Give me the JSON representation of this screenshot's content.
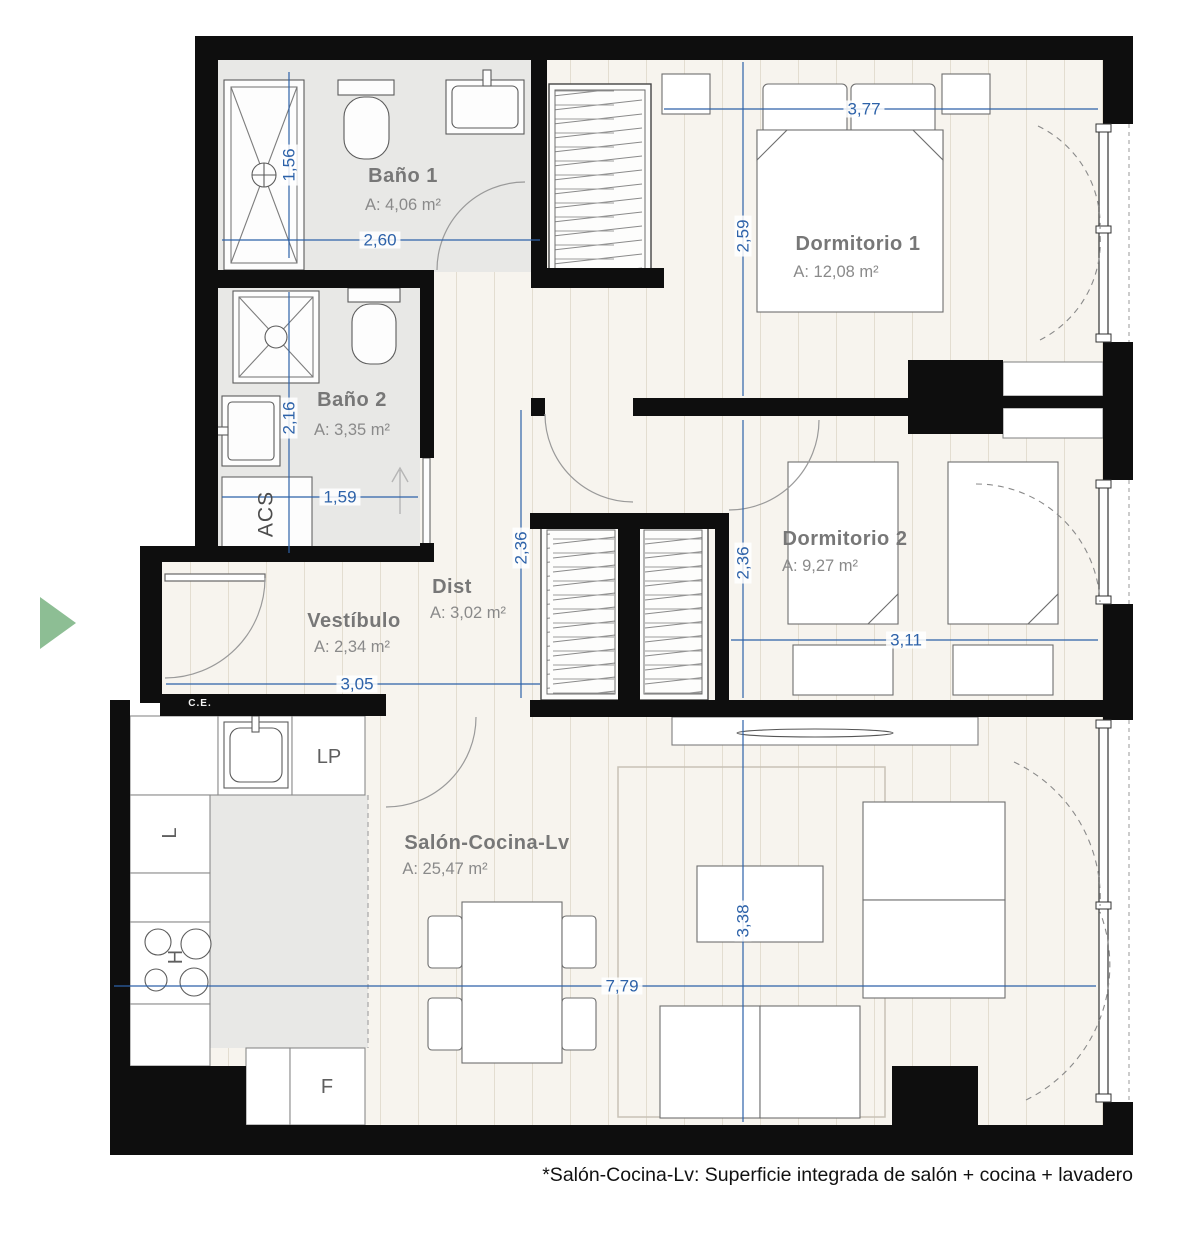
{
  "plan": {
    "footnote": "*Salón-Cocina-Lv: Superficie integrada de salón + cocina + lavadero",
    "rooms": {
      "bano1": {
        "name": "Baño 1",
        "area": "A: 4,06 m²",
        "width": "2,60",
        "height": "1,56"
      },
      "bano2": {
        "name": "Baño 2",
        "area": "A: 3,35 m²",
        "width": "1,59",
        "height": "2,16"
      },
      "dormitorio1": {
        "name": "Dormitorio 1",
        "area": "A: 12,08 m²",
        "width": "3,77",
        "height": "2,59"
      },
      "dormitorio2": {
        "name": "Dormitorio 2",
        "area": "A: 9,27 m²",
        "width": "3,11",
        "height": "2,36"
      },
      "dist": {
        "name": "Dist",
        "area": "A: 3,02 m²",
        "height": "2,36"
      },
      "vestibulo": {
        "name": "Vestíbulo",
        "area": "A: 2,34 m²",
        "width": "3,05"
      },
      "salon": {
        "name": "Salón-Cocina-Lv",
        "area": "A: 25,47 m²",
        "width": "7,79",
        "height": "3,38"
      }
    },
    "fixtures": {
      "acs": "ACS",
      "ce": "C.E.",
      "lp": "LP",
      "l": "L",
      "h": "H",
      "f": "F"
    },
    "colors": {
      "dimension_blue": "#2d62a9",
      "room_label_gray": "#777777",
      "wall_black": "#0e0e0e",
      "floor_wood": "#f7f4ee",
      "floor_tile": "#e8e8e6",
      "entry_arrow_green": "#8dbe94"
    }
  }
}
